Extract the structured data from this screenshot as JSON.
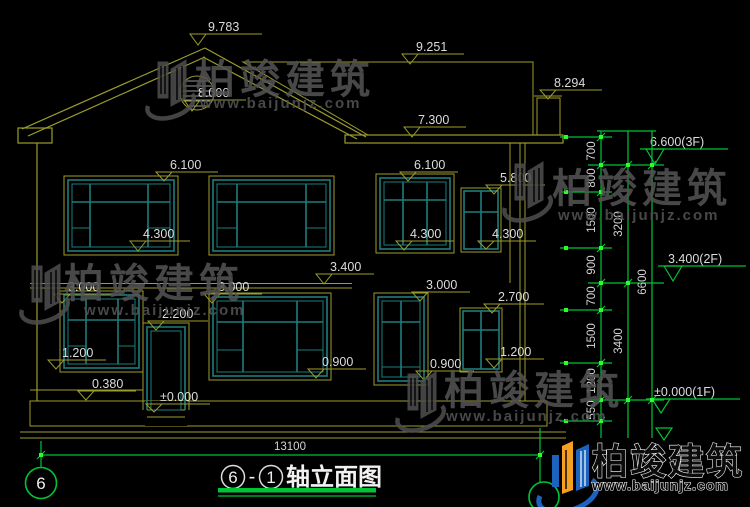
{
  "facade_markers": [
    "9.783",
    "8.000",
    "9.251",
    "7.300",
    "8.294",
    "6.100",
    "6.100",
    "5.800",
    "4.300",
    "4.300",
    "4.300",
    "3.400",
    "3.000",
    "3.000",
    "3.000",
    "2.700",
    "2.200",
    "1.200",
    "0.900",
    "0.900",
    "1.200",
    "0.380",
    "±0.000"
  ],
  "floor_flags": [
    "6.600(3F)",
    "3.400(2F)",
    "±0.000(1F)"
  ],
  "dims": {
    "inner": [
      "700",
      "800",
      "1500",
      "900",
      "700",
      "1500",
      "1200",
      "550"
    ],
    "mid": [
      "3200",
      "3400"
    ],
    "outer": [
      "6600"
    ],
    "bottom": "13100"
  },
  "grid": {
    "left_bubble": "6"
  },
  "title_block": {
    "axis_left": "6",
    "dash": "-",
    "axis_right": "1",
    "name": "轴立面图"
  },
  "watermark": {
    "brand": "柏竣建筑",
    "site": "www.baijunjz.com"
  },
  "colors": {
    "line_yellow": "#9c9c2c",
    "window_teal": "#1e7d7d",
    "dim_green": "#00c435",
    "defpoint_green": "#2bff2b",
    "text": "#dcdcdc",
    "watermark_gray": "#535353",
    "logo_blue": "#1b63bd",
    "logo_orange": "#f5a01f",
    "background": "#000000"
  }
}
